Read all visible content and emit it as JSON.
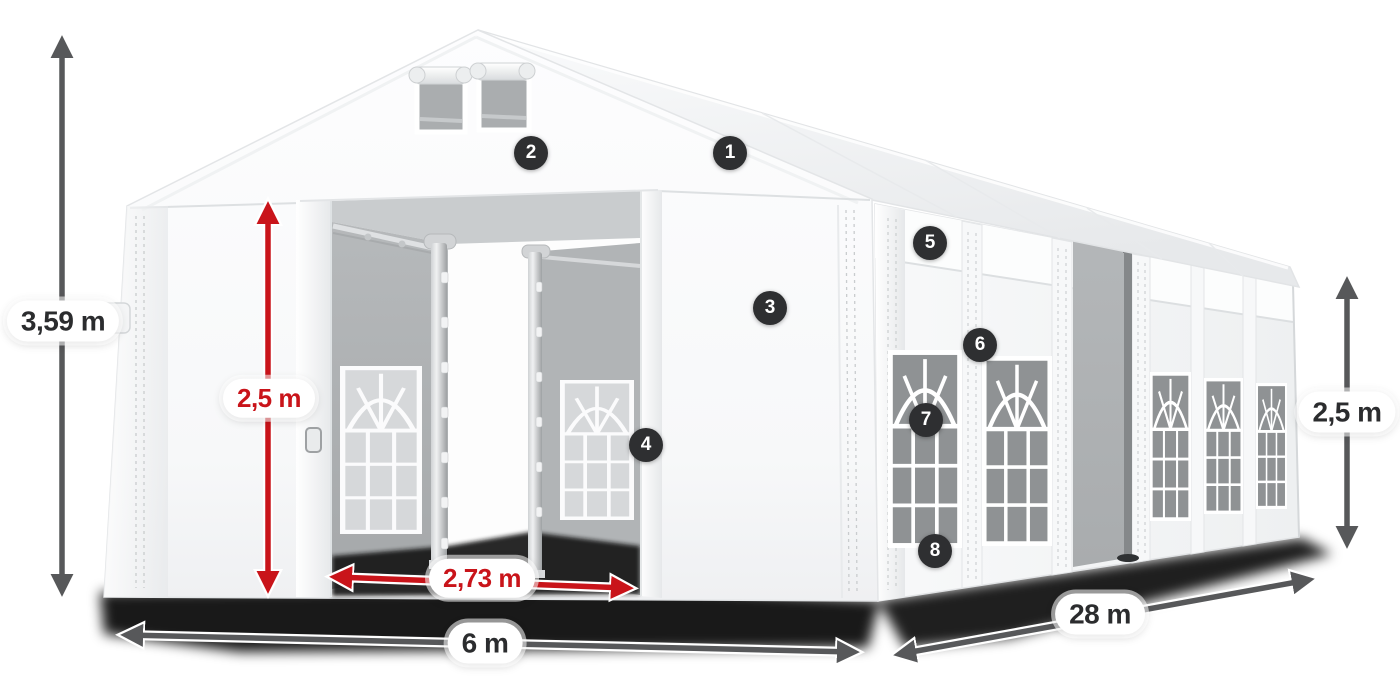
{
  "dimension_labels": {
    "total_height": "3,59 m",
    "entrance_height": "2,5 m",
    "entrance_width": "2,73 m",
    "front_width": "6 m",
    "side_length": "28 m",
    "side_wall_height": "2,5 m"
  },
  "callouts": [
    "1",
    "2",
    "3",
    "4",
    "5",
    "6",
    "7",
    "8"
  ],
  "colors": {
    "canvas_background": "#ffffff",
    "red_dimension": "#c9141a",
    "dark_dimension": "#57585a",
    "badge_background": "#2e2f31",
    "badge_text": "#ffffff",
    "label_text": "#2b2c2e"
  }
}
